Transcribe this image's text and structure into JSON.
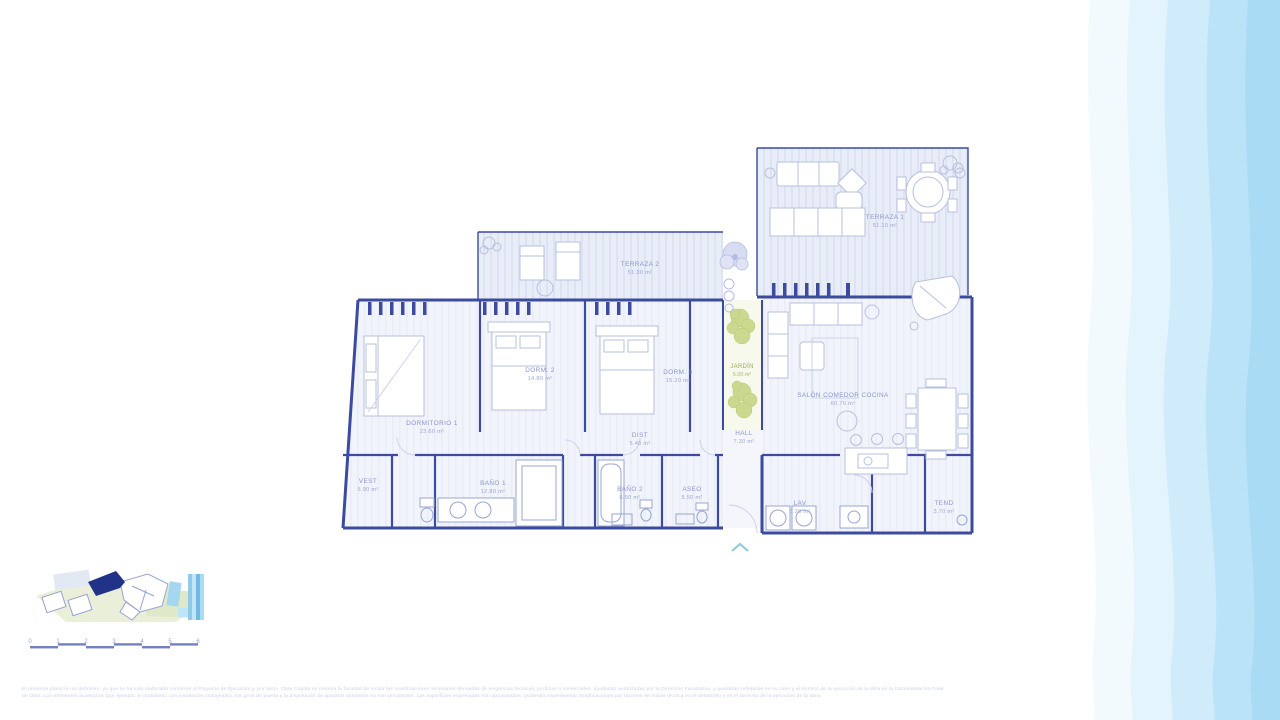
{
  "plan": {
    "rooms": {
      "terraza1": {
        "label": "TERRAZA 1",
        "area": "51.10 m²"
      },
      "terraza2": {
        "label": "TERRAZA 2",
        "area": "51.30 m²"
      },
      "dormitorio1": {
        "label": "DORMITORIO 1",
        "area": "23.60 m²"
      },
      "dorm2": {
        "label": "DORM. 2",
        "area": "14.80 m²"
      },
      "dorm3": {
        "label": "DORM. 3",
        "area": "15.20 m²"
      },
      "jardin": {
        "label": "JARDÍN",
        "area": "5.00 m²"
      },
      "salon": {
        "label": "SALÓN COMEDOR COCINA",
        "area": "60.70 m²"
      },
      "dist": {
        "label": "DIST",
        "area": "5.40 m²"
      },
      "hall": {
        "label": "HALL",
        "area": "7.30 m²"
      },
      "vest": {
        "label": "VEST",
        "area": "5.90 m²"
      },
      "bano1": {
        "label": "BAÑO 1",
        "area": "12.80 m²"
      },
      "bano2": {
        "label": "BAÑO 2",
        "area": "6.50 m²"
      },
      "aseo": {
        "label": "ASEO",
        "area": "5.50 m²"
      },
      "lav": {
        "label": "LAV",
        "area": "8.20 m²"
      },
      "tend": {
        "label": "TEND",
        "area": "3.70 m²"
      }
    },
    "scalebar": {
      "ticks": [
        "0",
        "1",
        "2",
        "3",
        "4",
        "5",
        "6"
      ]
    }
  },
  "footer": {
    "disclaimer_line1": "El presente plano no es definitivo, ya que se ha sido elaborado conforme al Proyecto de Ejecución y, por tanto, Obra Capital se reserva la facultad de incluir las modificaciones necesarias derivadas de exigencias técnicas, jurídicas o comerciales, quedando autorizadas por la Dirección Facultativa, y quedarán reflejadas en su caso y al término de la ejecución de la obra en la Documentación Final",
    "disclaimer_line2": "de Obra. Los elementos accesorios (por ejemplo, el mobiliario, con instalación incluyendo), los giros de puerta y la disposición de aparatos sanitarios no son vinculantes. Las superficies expresadas son aproximadas, pudiendo experimentar modificaciones por razones de índole técnica en el desarrollo y en el derecho de la ejecución de la obra."
  },
  "colors": {
    "wall": "#3c4b9e",
    "furniture": "#b7c0de",
    "fixture": "#98a5d2",
    "room_label": "#8a97cd",
    "garden_label": "#9aad5a",
    "garden_green": "#c3d47f",
    "highlight_building": "#203387",
    "scalebar": "#5b6cb8",
    "entry_arrow": "#8ccbd9",
    "wave_band_1": "#f3fafd",
    "wave_band_2": "#e4f4fc",
    "wave_band_3": "#d0ebf9",
    "wave_band_4": "#bae3f7",
    "wave_band_5": "#a9dcf4"
  }
}
